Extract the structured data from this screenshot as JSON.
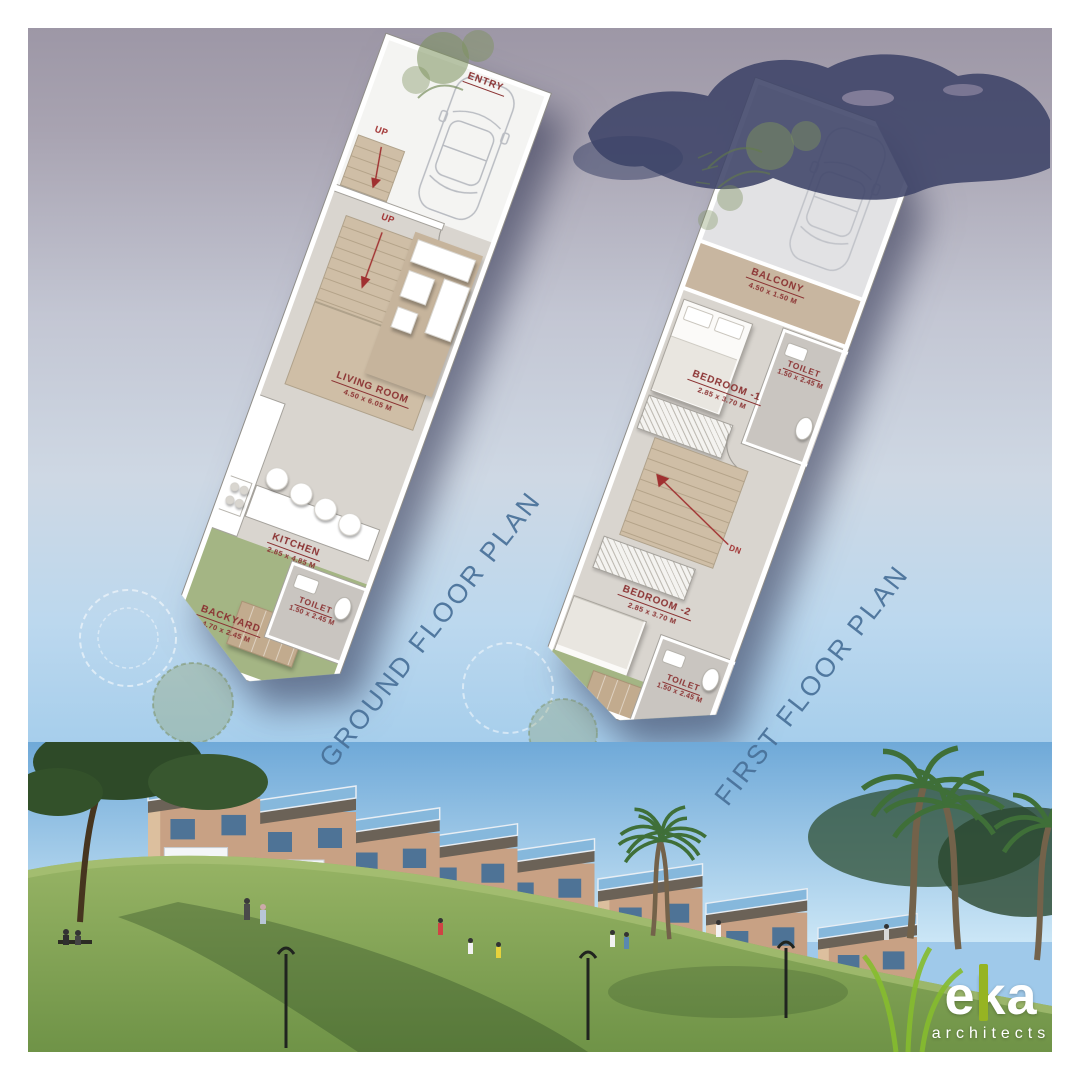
{
  "poster": {
    "ground_floor": {
      "title": "GROUND FLOOR PLAN",
      "entry_label": "ENTRY",
      "stair_up_entry": "UP",
      "stair_up_main": "UP",
      "rooms": {
        "living_room": {
          "name": "LIVING ROOM",
          "dim": "4.50 x 6.05 M"
        },
        "kitchen": {
          "name": "KITCHEN",
          "dim": "2.85 x 4.85 M"
        },
        "toilet": {
          "name": "TOILET",
          "dim": "1.50 x 2.45 M"
        },
        "backyard": {
          "name": "BACKYARD",
          "dim": "4.70 x 2.45 M"
        }
      }
    },
    "first_floor": {
      "title": "FIRST FLOOR PLAN",
      "stair_down": "DN",
      "rooms": {
        "balcony": {
          "name": "BALCONY",
          "dim": "4.50 x 1.50 M"
        },
        "bedroom1": {
          "name": "BEDROOM -1",
          "dim": "2.85 x 3.70 M"
        },
        "toilet1": {
          "name": "TOILET",
          "dim": "1.50 x 2.45 M"
        },
        "bedroom2": {
          "name": "BEDROOM -2",
          "dim": "2.85 x 3.70 M"
        },
        "toilet2": {
          "name": "TOILET",
          "dim": "1.50 x 2.45 M"
        }
      }
    },
    "logo": {
      "brand": "eka",
      "tagline": "architects"
    },
    "colors": {
      "label_red": "#8b3232",
      "title_blue": "#48709a",
      "plan_floor": "#d9d5cf",
      "plan_tan": "#c8b6a0",
      "backyard_green": "#a4b584",
      "logo_green": "#96b422",
      "sky_top": "#9d97a6",
      "sky_blue": "#a6ceec"
    }
  }
}
